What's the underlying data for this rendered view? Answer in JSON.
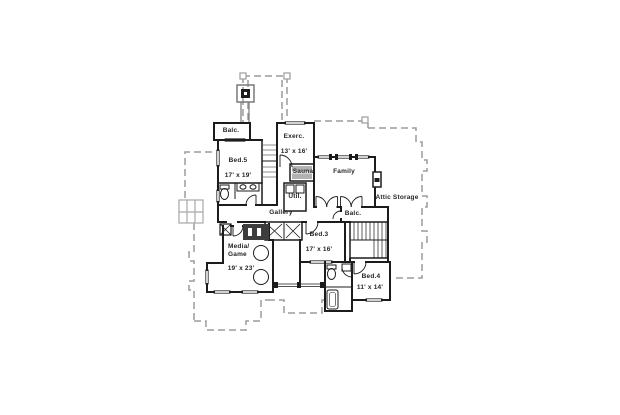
{
  "plan": {
    "type": "second-floor-plan",
    "colors": {
      "background": "#ffffff",
      "wall": "#1c1c1c",
      "roof_dash": "#9b9b9b",
      "sauna_bench_fill": "#b2b2b2",
      "closet_fill": "#3d3d3d",
      "chimney_gray": "#7a7a7a"
    },
    "rooms": [
      {
        "id": "balc-top",
        "label": "Balc."
      },
      {
        "id": "bed5",
        "label": "Bed.5",
        "dims": "17' x 19'"
      },
      {
        "id": "exerc",
        "label": "Exerc.",
        "dims": "13' x 16'"
      },
      {
        "id": "sauna",
        "label": "Sauna"
      },
      {
        "id": "family",
        "label": "Family"
      },
      {
        "id": "util",
        "label": "Util."
      },
      {
        "id": "gallery",
        "label": "Gallery"
      },
      {
        "id": "attic",
        "label": "Attic Storage"
      },
      {
        "id": "balc-right",
        "label": "Balc."
      },
      {
        "id": "bed3",
        "label": "Bed.3",
        "dims": "17' x 16'"
      },
      {
        "id": "media-game",
        "label": "Media/",
        "label2": "Game",
        "dims": "19' x 23'"
      },
      {
        "id": "bed4",
        "label": "Bed.4",
        "dims": "11' x 14'"
      }
    ]
  }
}
